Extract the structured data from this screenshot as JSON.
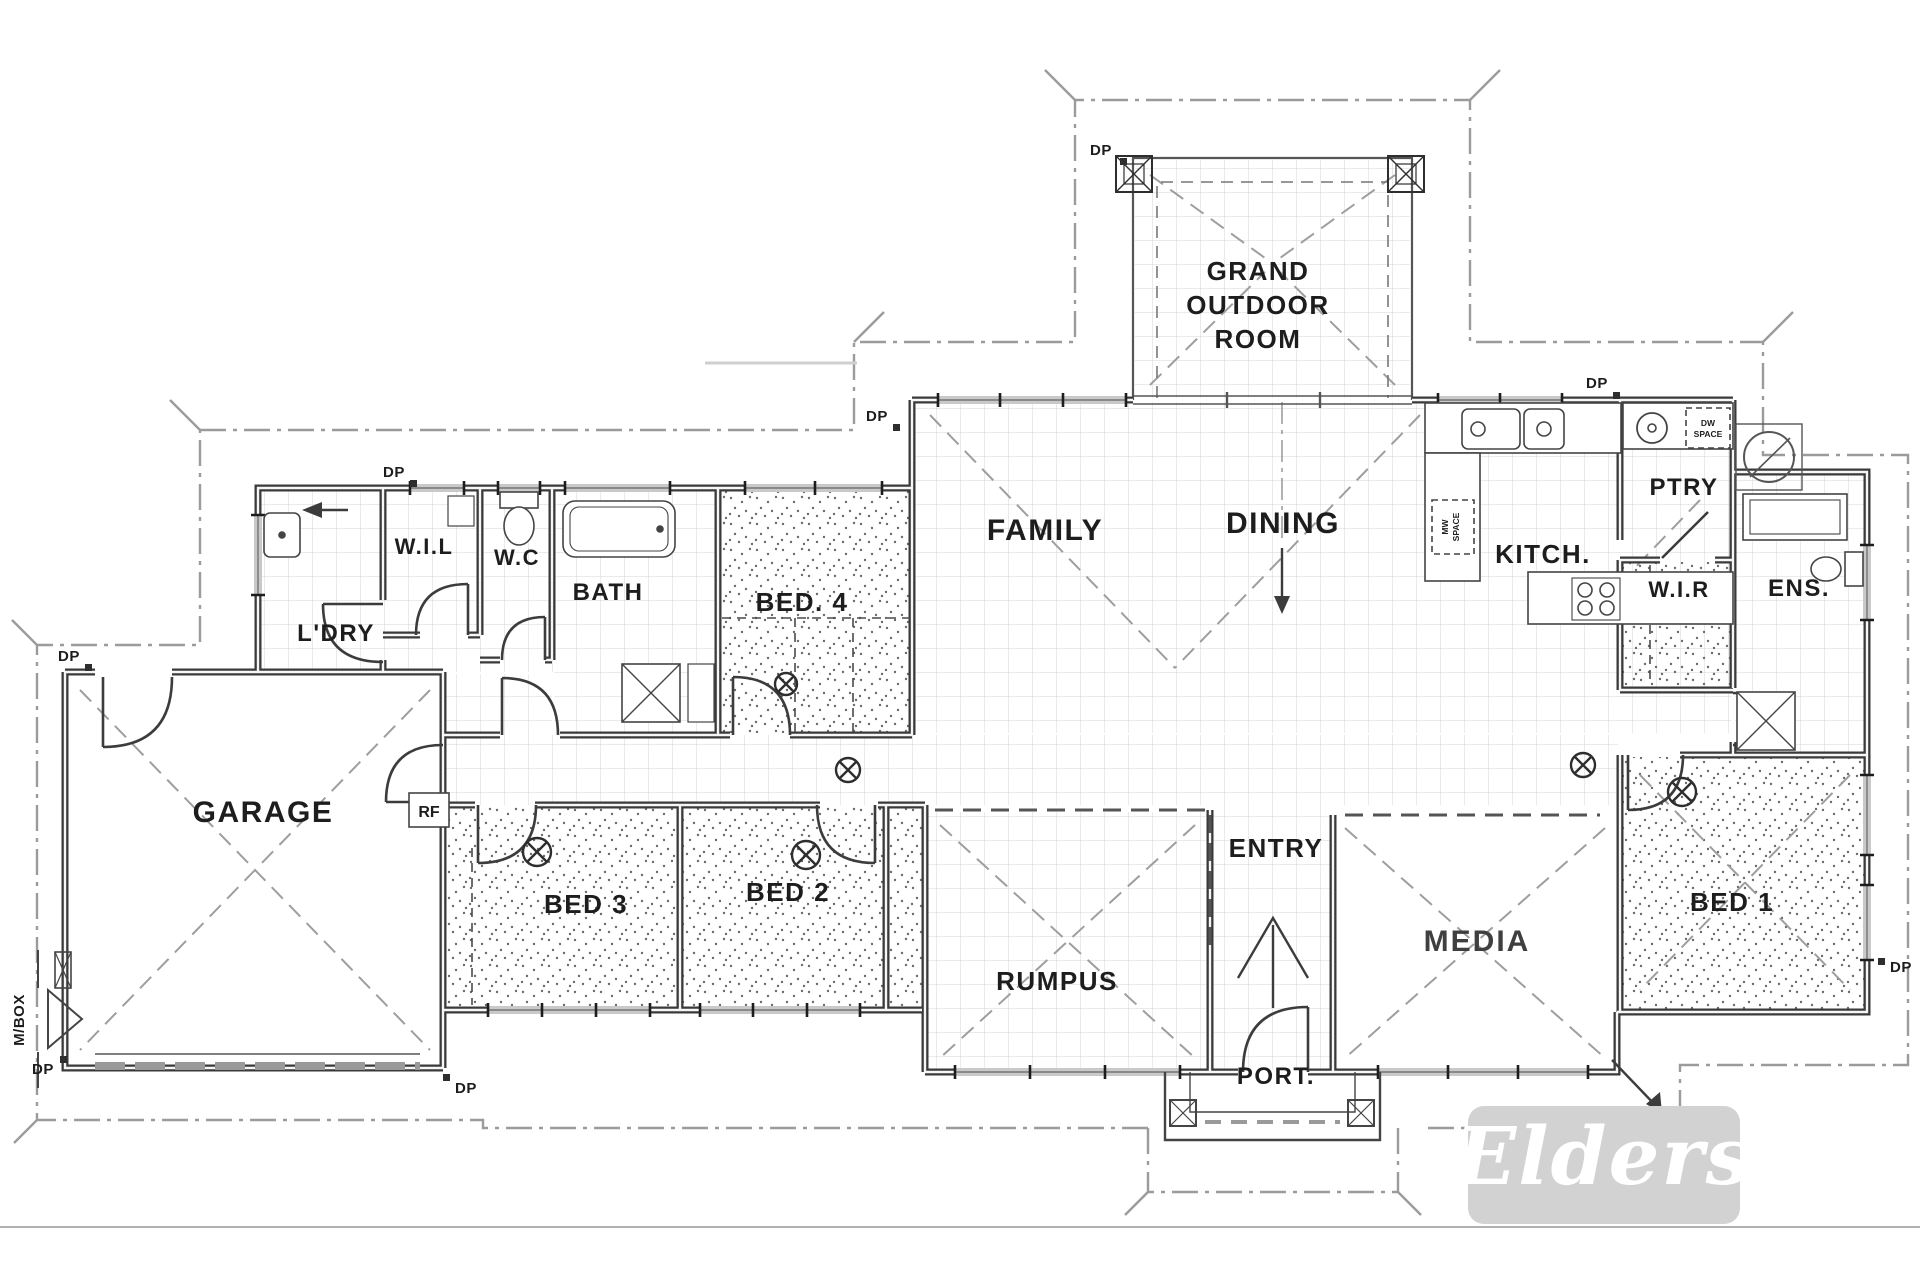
{
  "page": {
    "background": "#ffffff",
    "footer_line_color": "#b0b0b0"
  },
  "drawing": {
    "ink": "#2e2e2e",
    "eave_color": "#9b9b9b",
    "tile_color": "#d4d4d4",
    "stipple_color": "#454545",
    "window_color": "#c9c9c9"
  },
  "labels": {
    "grand1": "GRAND",
    "grand2": "OUTDOOR",
    "grand3": "ROOM",
    "family": "FAMILY",
    "dining": "DINING",
    "kitchen": "KITCH.",
    "pantry": "PTRY",
    "walk_in_linen": "W.I.L",
    "wc": "W.C",
    "bath": "BATH",
    "bed4": "BED. 4",
    "laundry": "L'DRY",
    "garage": "GARAGE",
    "bed3": "BED 3",
    "bed2": "BED 2",
    "rumpus": "RUMPUS",
    "entry": "ENTRY",
    "media": "MEDIA",
    "bed1": "BED 1",
    "wir": "W.I.R",
    "ens": "ENS.",
    "port": "PORT.",
    "rf": "RF",
    "mbox": "M/BOX",
    "dp": "DP",
    "mw1": "MW",
    "mw2": "SPACE",
    "dw1": "DW",
    "dw2": "SPACE"
  },
  "logo": {
    "text": "Elders",
    "background": "#d2d2d2",
    "text_color": "#ffffff"
  }
}
